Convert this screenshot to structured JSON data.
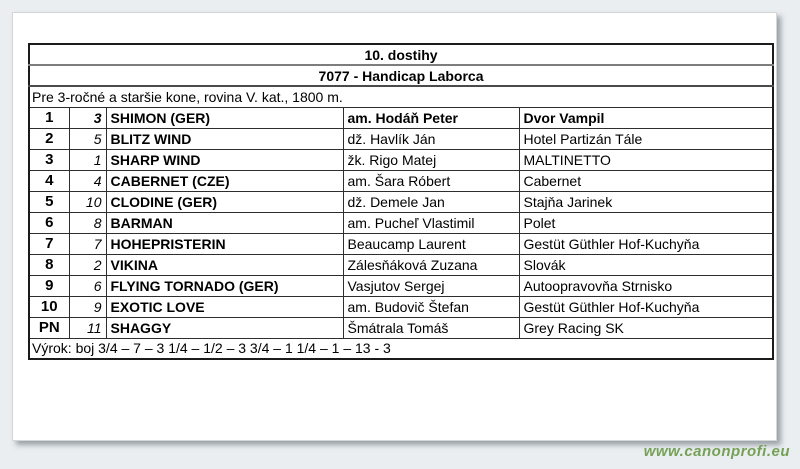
{
  "race": {
    "title": "10. dostihy",
    "subtitle": "7077 - Handicap Laborca",
    "conditions": "Pre 3-ročné a staršie kone, rovina V. kat., 1800 m.",
    "verdict": "Výrok: boj 3/4 – 7 – 3 1/4 – 1/2 – 3 3/4 – 1 1/4 – 1 – 13 - 3"
  },
  "results": {
    "rows": [
      {
        "pos": "1",
        "num": "3",
        "horse": "SHIMON (GER)",
        "rider": "am. Hodáň Peter",
        "owner": "Dvor Vampil"
      },
      {
        "pos": "2",
        "num": "5",
        "horse": "BLITZ WIND",
        "rider": "dž. Havlík Ján",
        "owner": "Hotel Partizán Tále"
      },
      {
        "pos": "3",
        "num": "1",
        "horse": "SHARP WIND",
        "rider": "žk. Rigo Matej",
        "owner": "MALTINETTO"
      },
      {
        "pos": "4",
        "num": "4",
        "horse": "CABERNET (CZE)",
        "rider": "am. Šara Róbert",
        "owner": "Cabernet"
      },
      {
        "pos": "5",
        "num": "10",
        "horse": "CLODINE (GER)",
        "rider": "dž. Demele Jan",
        "owner": "Stajňa Jarinek"
      },
      {
        "pos": "6",
        "num": "8",
        "horse": "BARMAN",
        "rider": "am. Pucheľ Vlastimil",
        "owner": "Polet"
      },
      {
        "pos": "7",
        "num": "7",
        "horse": "HOHEPRISTERIN",
        "rider": "Beaucamp Laurent",
        "owner": "Gestüt Güthler Hof-Kuchyňa"
      },
      {
        "pos": "8",
        "num": "2",
        "horse": "VIKINA",
        "rider": "Zálesňáková Zuzana",
        "owner": "Slovák"
      },
      {
        "pos": "9",
        "num": "6",
        "horse": "FLYING TORNADO (GER)",
        "rider": "Vasjutov Sergej",
        "owner": "Autoopravovňa Strnisko"
      },
      {
        "pos": "10",
        "num": "9",
        "horse": "EXOTIC LOVE",
        "rider": "am. Budovič Štefan",
        "owner": "Gestüt Güthler Hof-Kuchyňa"
      },
      {
        "pos": "PN",
        "num": "11",
        "horse": "SHAGGY",
        "rider": "Šmátrala Tomáš",
        "owner": "Grey Racing SK"
      }
    ]
  },
  "page": {
    "watermark": "www.canonprofi.eu",
    "colors": {
      "watermark_green": "#75a156",
      "page_background": "#eaeef1",
      "sheet_background": "#ffffff",
      "table_border": "#1b1b1b"
    }
  }
}
